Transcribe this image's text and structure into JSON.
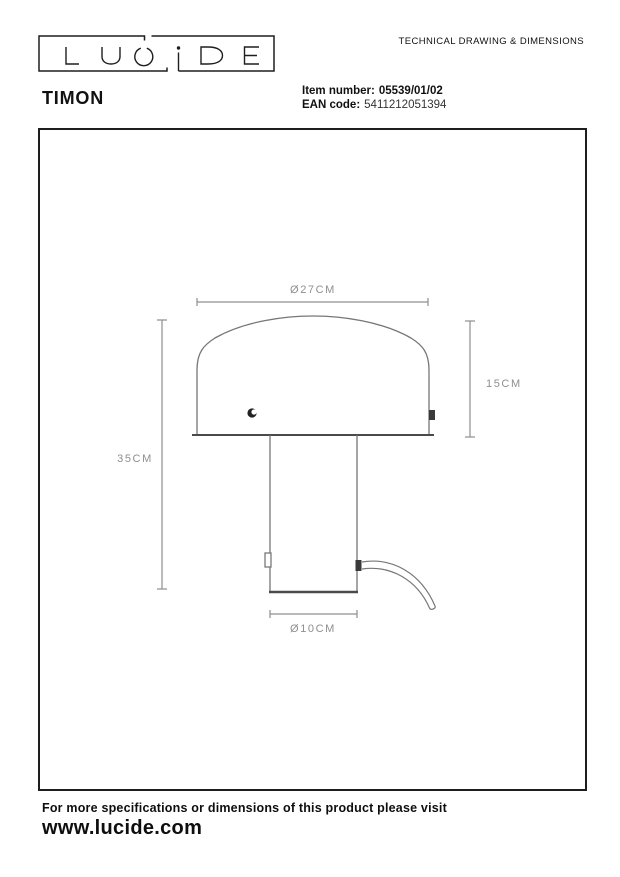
{
  "header": {
    "title": "TECHNICAL DRAWING & DIMENSIONS"
  },
  "logo": {
    "text": "LUCIDE"
  },
  "product": {
    "name": "TIMON",
    "item_label": "Item number:",
    "item_value": "05539/01/02",
    "ean_label": "EAN code:",
    "ean_value": "5411212051394"
  },
  "drawing": {
    "type": "technical-drawing-front-view-table-lamp",
    "dim_shade_diameter": "Ø27CM",
    "dim_shade_height": "15CM",
    "dim_total_height": "35CM",
    "dim_base_diameter": "Ø10CM"
  },
  "footer": {
    "line": "For more specifications or dimensions of this product please visit",
    "url": "www.lucide.com"
  },
  "colors": {
    "background": "#ffffff",
    "ink": "#1e1e1e",
    "outline_gray": "#767676",
    "dimension_gray": "#8d9090",
    "detail_dark": "#3a3a3a"
  }
}
